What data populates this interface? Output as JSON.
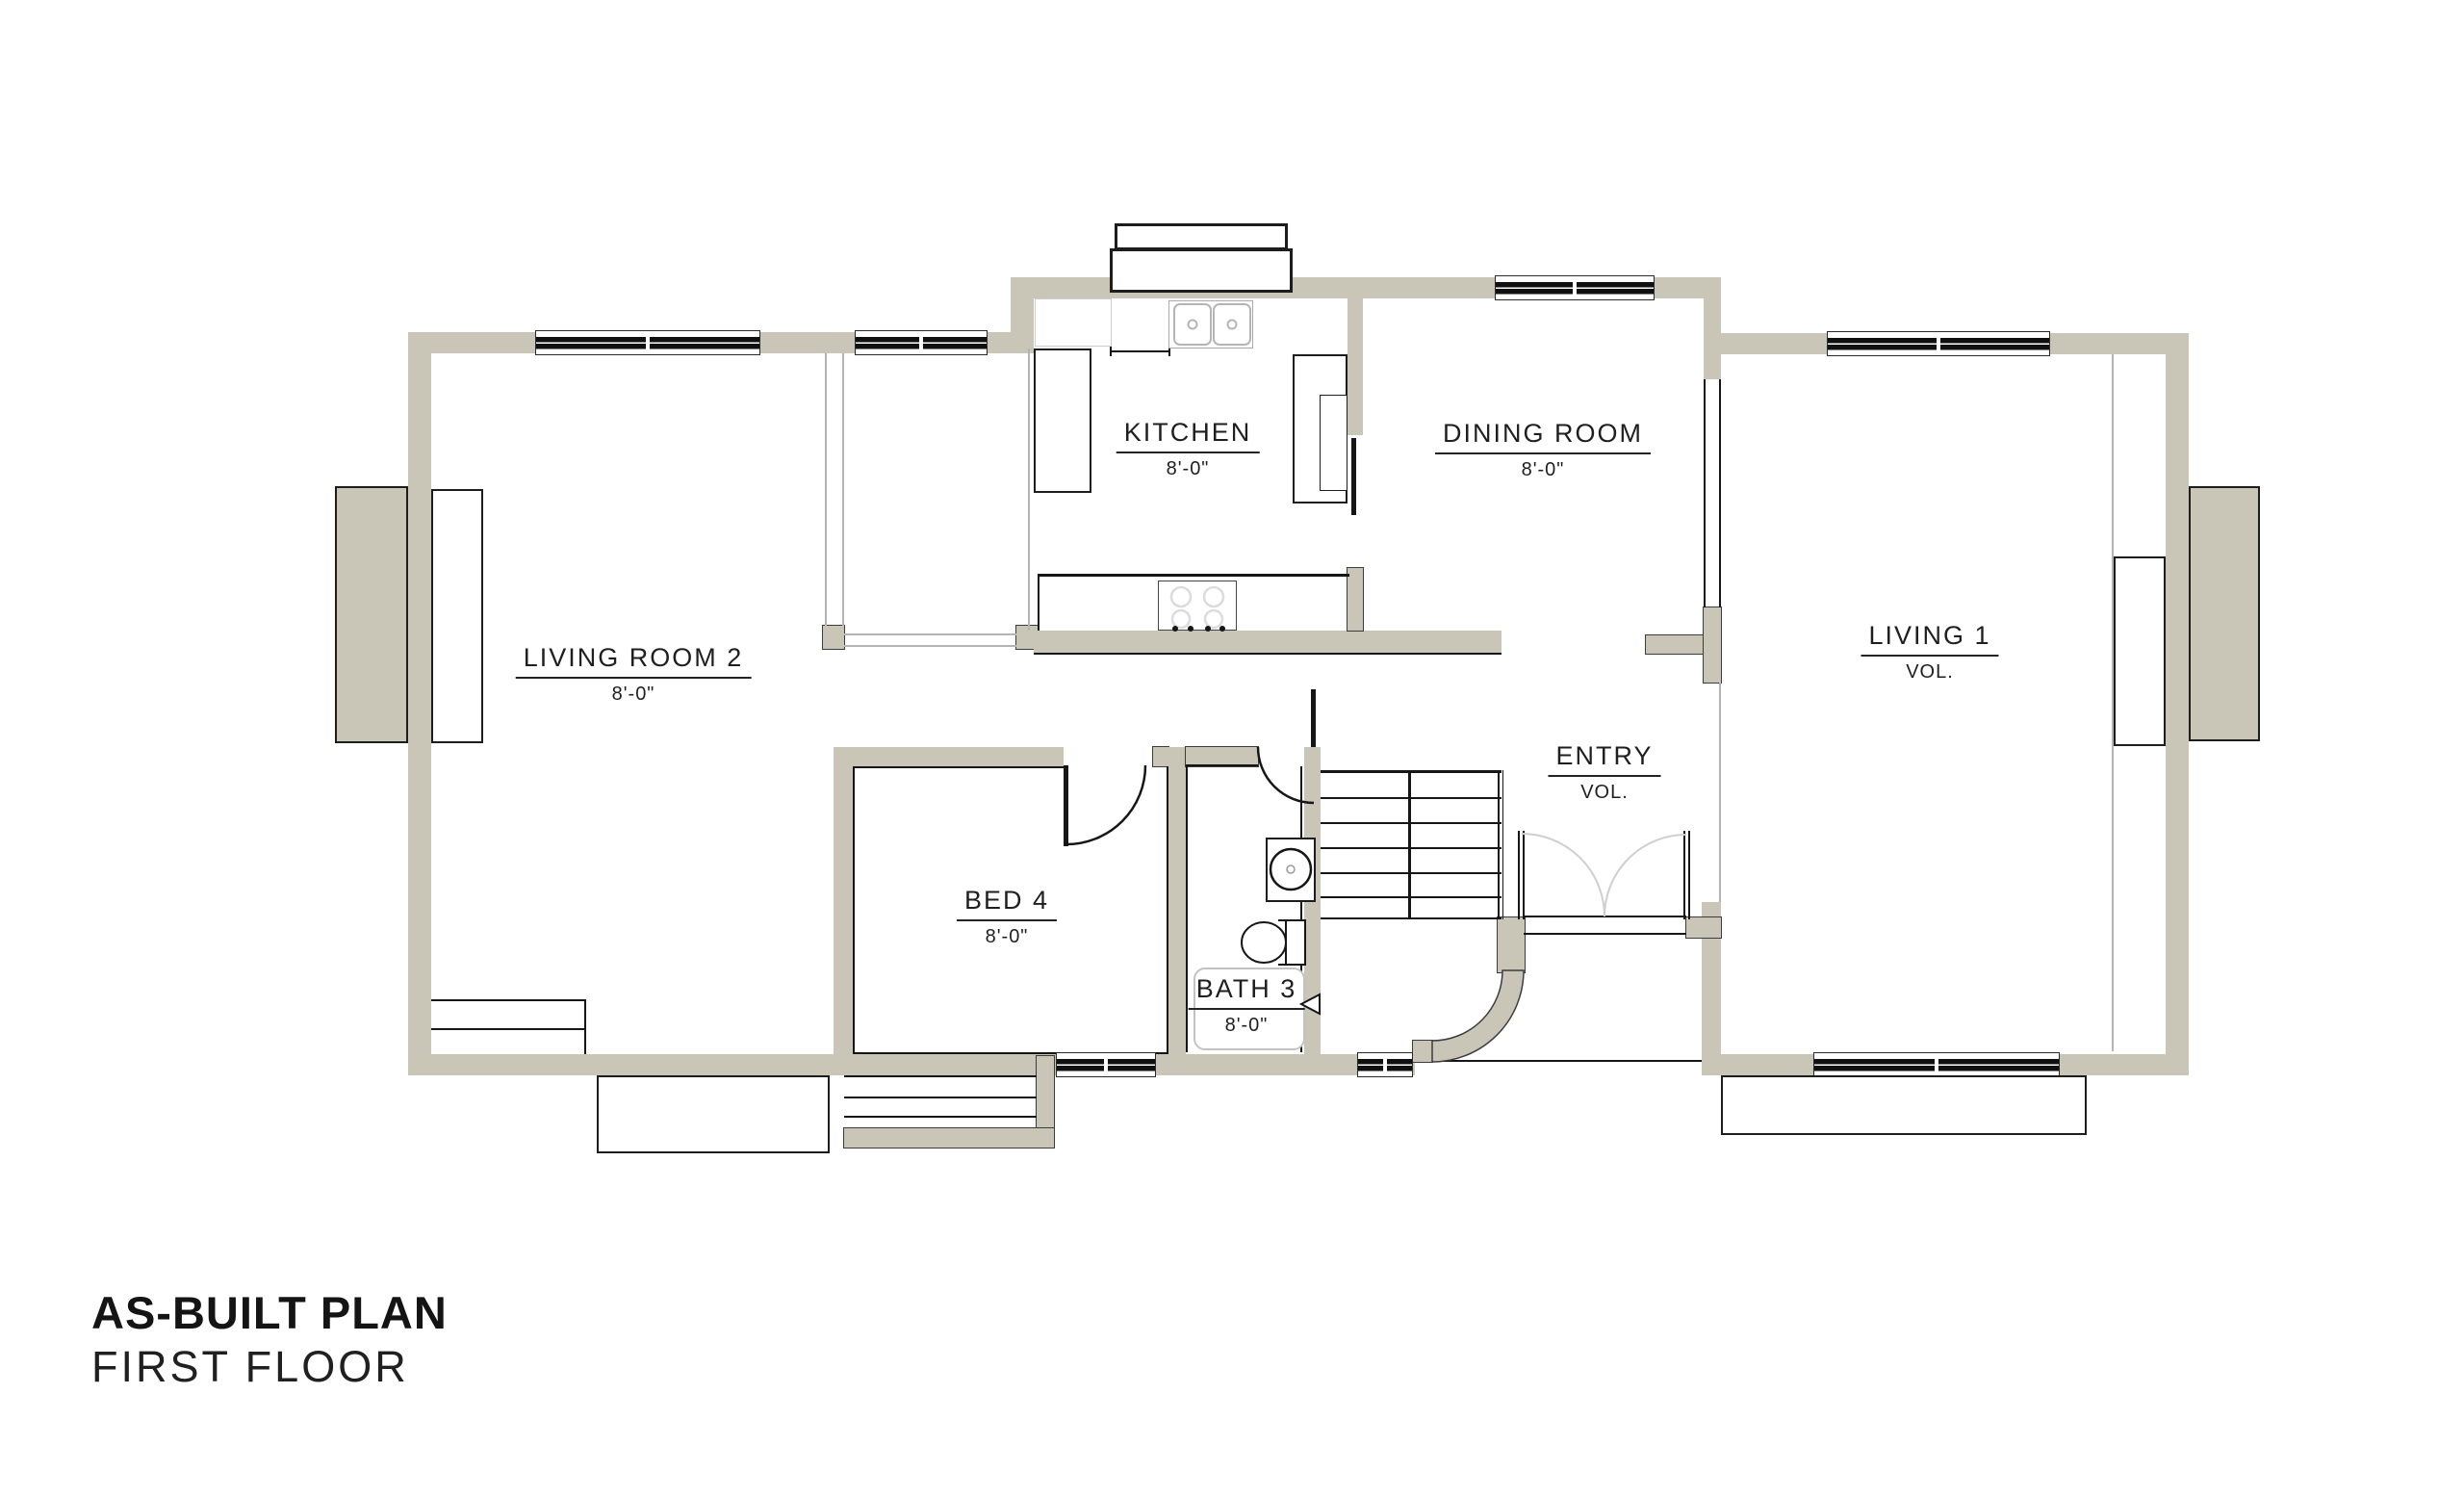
{
  "title": {
    "main": "AS-BUILT PLAN",
    "sub": "FIRST FLOOR"
  },
  "rooms": {
    "living_room_2": {
      "name": "LIVING ROOM 2",
      "dim": "8'-0\""
    },
    "kitchen": {
      "name": "KITCHEN",
      "dim": "8'-0\""
    },
    "dining_room": {
      "name": "DINING ROOM",
      "dim": "8'-0\""
    },
    "living_1": {
      "name": "LIVING 1",
      "dim": "VOL."
    },
    "bed_4": {
      "name": "BED 4",
      "dim": "8'-0\""
    },
    "bath_3": {
      "name": "BATH 3",
      "dim": "8'-0\""
    },
    "entry": {
      "name": "ENTRY",
      "dim": "VOL."
    }
  },
  "colors": {
    "wall": "#c9c6b7",
    "line": "#161616",
    "light_line": "#b4b4b4",
    "door_swing_light": "#cfcfcf",
    "paper": "#ffffff"
  }
}
